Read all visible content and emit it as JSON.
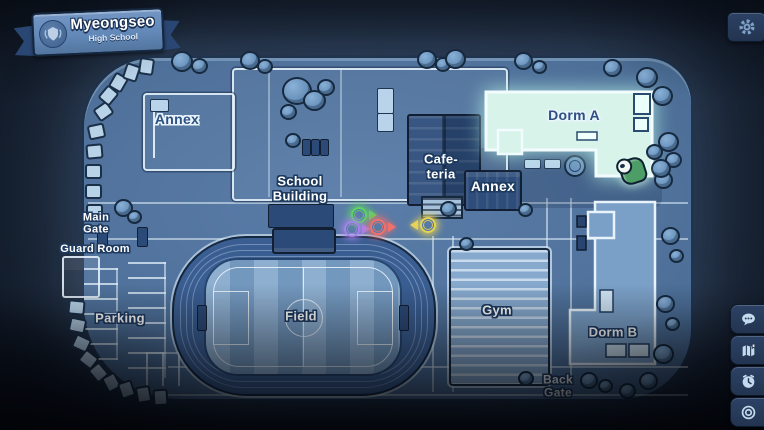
{
  "banner": {
    "title": "Myeongseo",
    "subtitle": "High School",
    "emblem_icon": "school-crest-icon"
  },
  "map_labels": {
    "annex_nw": "Annex",
    "school_building": "School\nBuilding",
    "cafeteria": "Cafe-\nteria",
    "annex_center": "Annex",
    "dorm_a": "Dorm A",
    "main_gate": "Main\nGate",
    "guard_room": "Guard Room",
    "parking": "Parking",
    "field": "Field",
    "gym": "Gym",
    "dorm_b": "Dorm B",
    "back_gate": "Back\nGate"
  },
  "markers": {
    "npc_colors": {
      "green": "#5fd463",
      "purple": "#a782ea",
      "red": "#f2706b",
      "yellow": "#e6d254"
    },
    "highlighted_location": "Dorm A"
  },
  "side_buttons": [
    {
      "icon": "chat-bubble-icon"
    },
    {
      "icon": "map-journal-icon"
    },
    {
      "icon": "clock-icon"
    },
    {
      "icon": "target-circle-icon"
    }
  ],
  "header": {
    "settings_icon": "gear-icon"
  },
  "colors": {
    "background": "#131b28",
    "map_ground": "#51739d",
    "building_dark": "#2e4d7b",
    "room_highlight": "#d9f4ec",
    "outline_light": "#e4eff8",
    "label_outline": "#1e3a5f"
  }
}
